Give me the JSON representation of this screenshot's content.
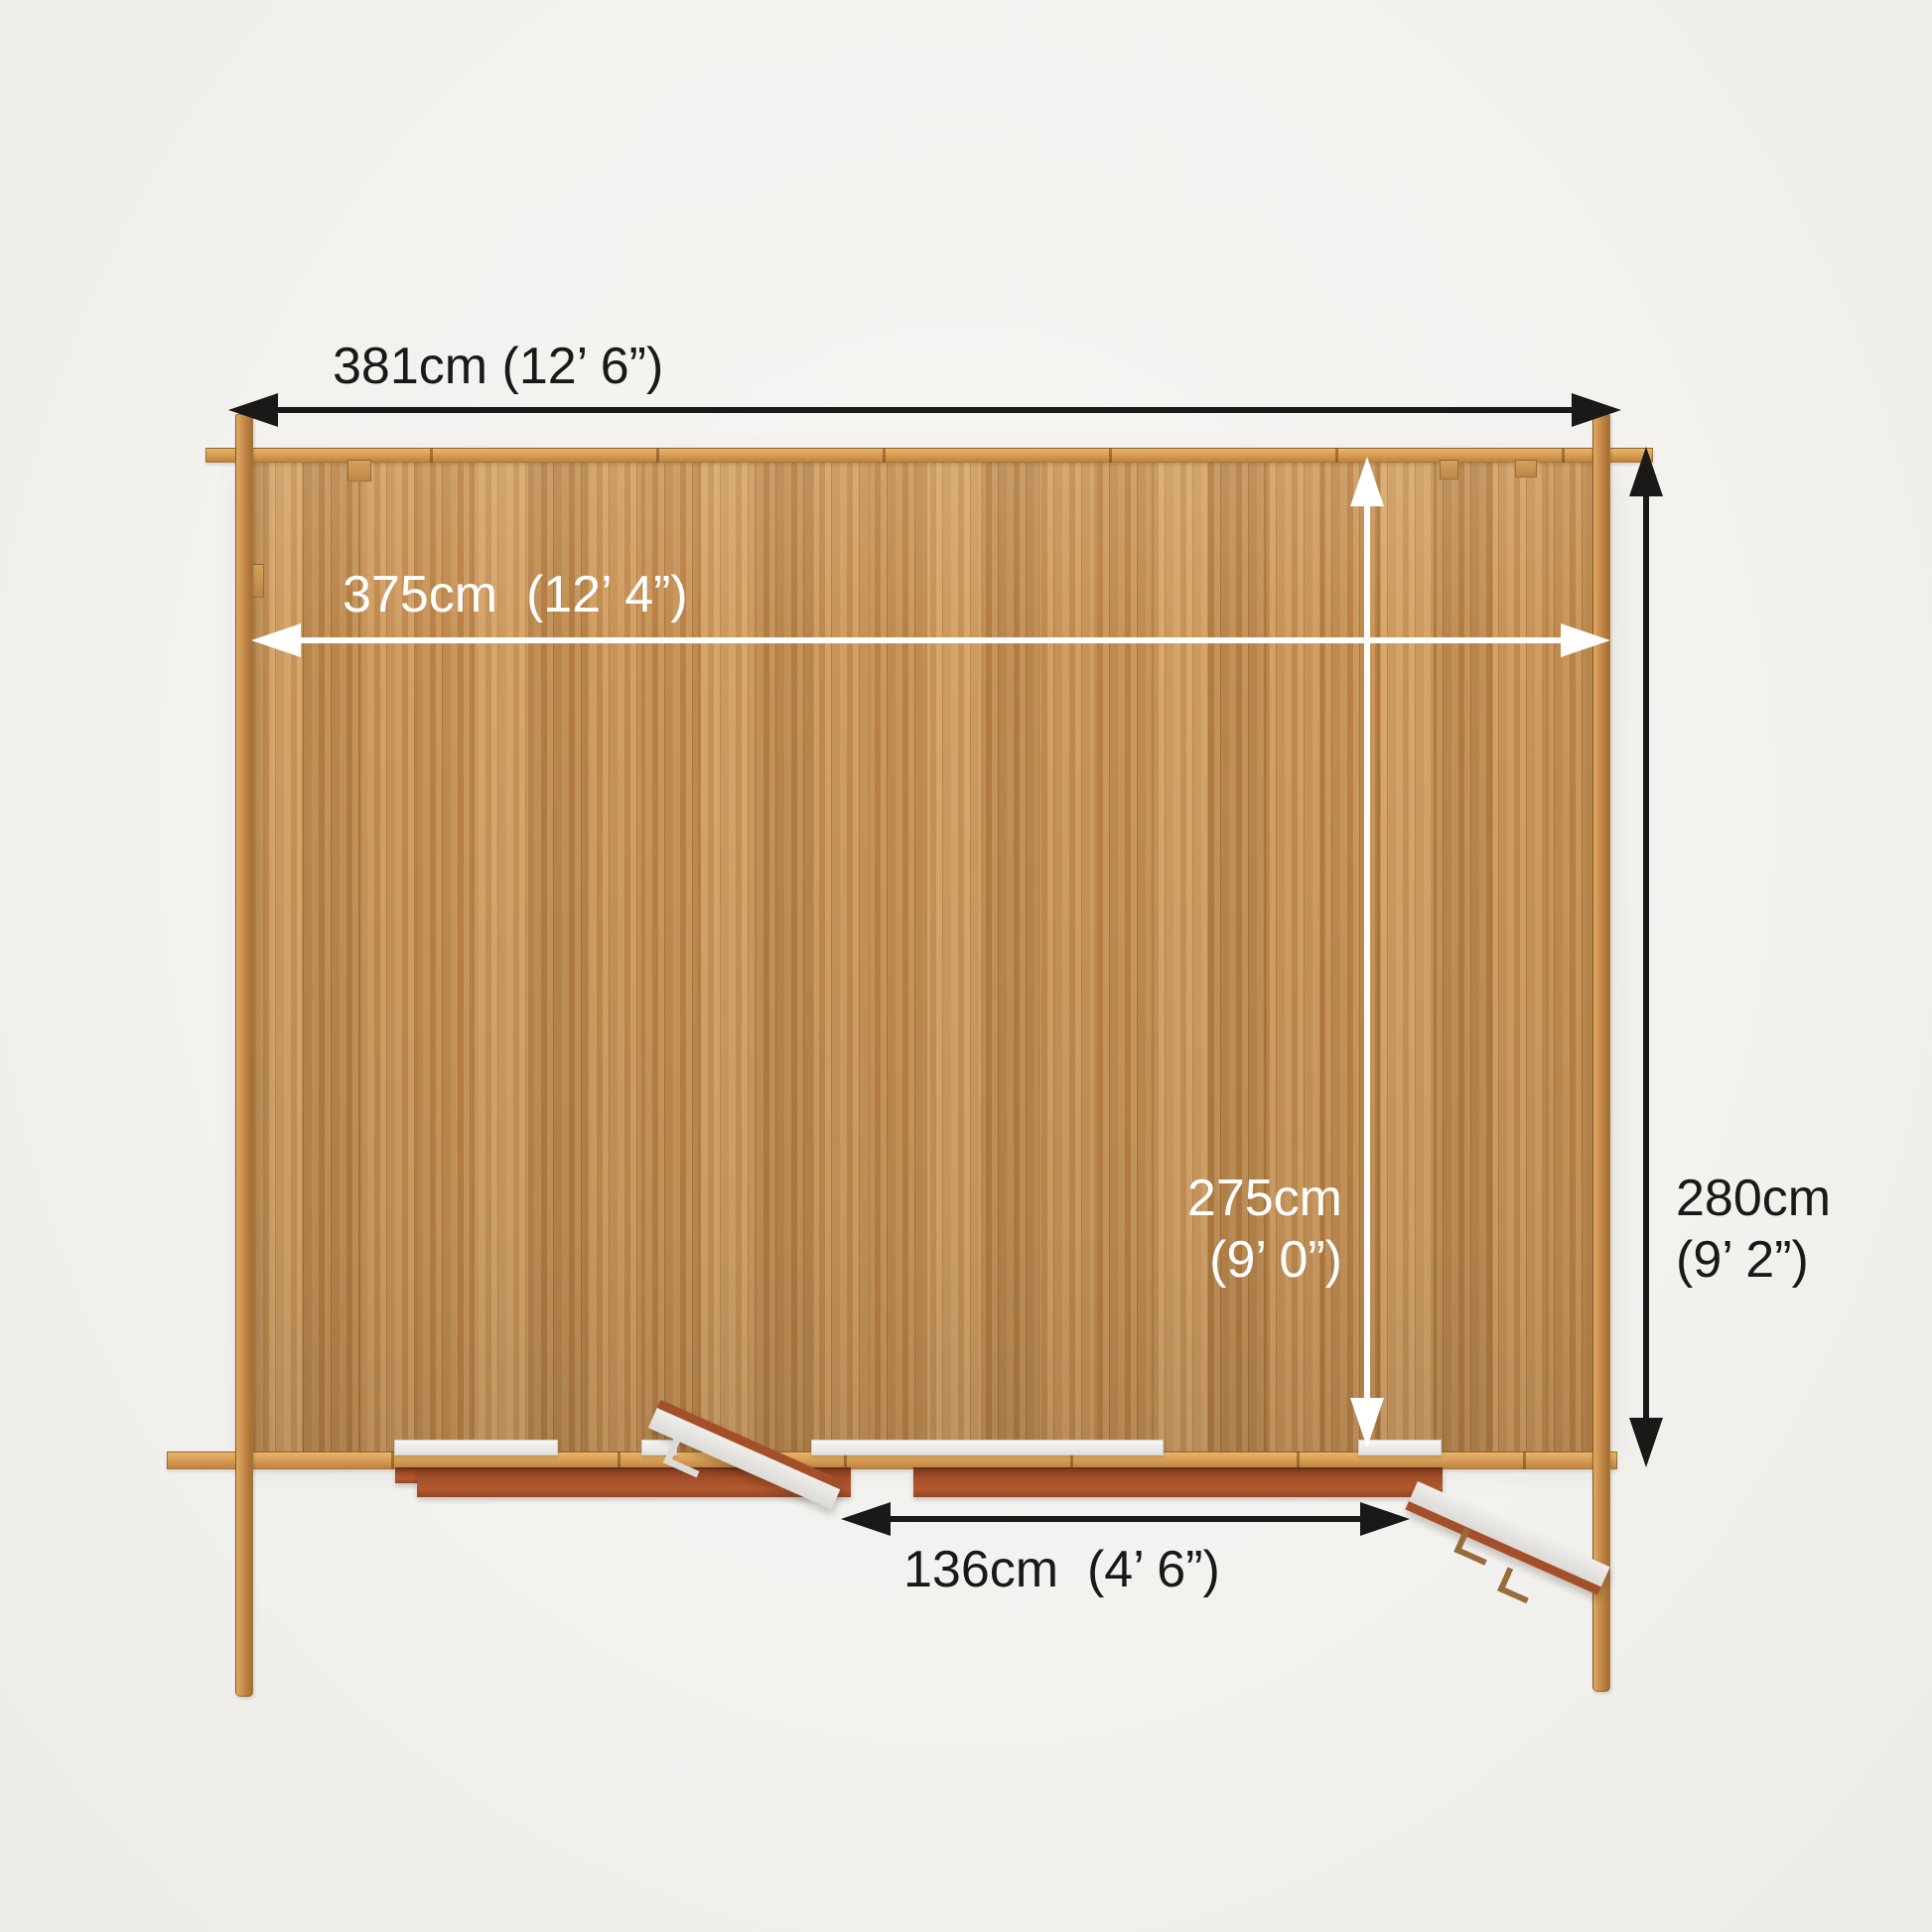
{
  "diagram": {
    "labels": {
      "external_width": "381cm (12’ 6”)",
      "internal_width": "375cm  (12’ 4”)",
      "external_depth_cm": "280cm",
      "external_depth_ft": "(9’ 2”)",
      "internal_depth_cm": "275cm",
      "internal_depth_ft": "(9’ 0”)",
      "door_width": "136cm  (4’ 6”)"
    },
    "colors": {
      "background": "#f3f2ef",
      "wood_plank": "#c48e52",
      "beam_tan": "#d9a055",
      "corner_log": "#c08545",
      "door_frame_red": "#a3502a",
      "door_leaf_white": "#e9e7e3",
      "dimension_dark": "#1b1917",
      "dimension_light": "#ffffff"
    }
  }
}
